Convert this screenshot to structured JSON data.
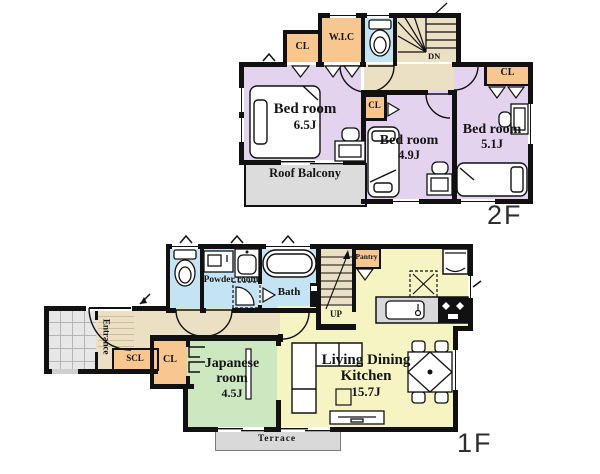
{
  "colors": {
    "wall": "#111111",
    "bedroom": "#e4d3ee",
    "ldk": "#f6f4c2",
    "japanese_room": "#cde8c0",
    "water": "#c4e4f4",
    "closet": "#f7c78f",
    "hall": "#ebdfc4",
    "balcony": "#dcdcdc",
    "terrace": "#d9d9d9",
    "counter": "#d9d9d9"
  },
  "floor2": {
    "label": "2F",
    "bedroom_a": {
      "name": "Bed room",
      "size": "6.5J"
    },
    "bedroom_b": {
      "name": "Bed room",
      "size": "4.9J"
    },
    "bedroom_c": {
      "name": "Bed room",
      "size": "5.1J"
    },
    "roof_balcony": "Roof Balcony",
    "wic": "W.I.C",
    "cl_left": "CL",
    "cl_mid": "CL",
    "cl_right": "CL",
    "stairs_dn": "DN"
  },
  "floor1": {
    "label": "1F",
    "ldk": {
      "name": "Living Dining Kitchen",
      "size": "15.7J"
    },
    "japanese_room": {
      "name": "Japanese room",
      "size": "4.5J"
    },
    "powder_room": "Powder room",
    "bath": "Bath",
    "entrance": "Entrance",
    "scl": "SCL",
    "cl": "CL",
    "pantry": "Pantry",
    "terrace": "Terrace",
    "stairs_up": "UP"
  },
  "icons": {
    "bed": "bed-icon",
    "desk_chair": "desk-chair-icon",
    "toilet": "toilet-icon",
    "bathtub": "bathtub-icon",
    "washbasin": "washbasin-icon",
    "washing_machine": "washing-machine-icon",
    "refrigerator": "refrigerator-icon",
    "stove": "stove-icon",
    "sink": "sink-icon",
    "range_hood": "range-hood-icon",
    "sofa": "sofa-icon",
    "dining_set": "dining-set-icon",
    "tv_board": "tv-board-icon",
    "stairs": "stairs-icon",
    "door_arc": "door-arc-icon",
    "folding_door": "folding-door-icon",
    "sliding_door": "sliding-door-icon"
  }
}
